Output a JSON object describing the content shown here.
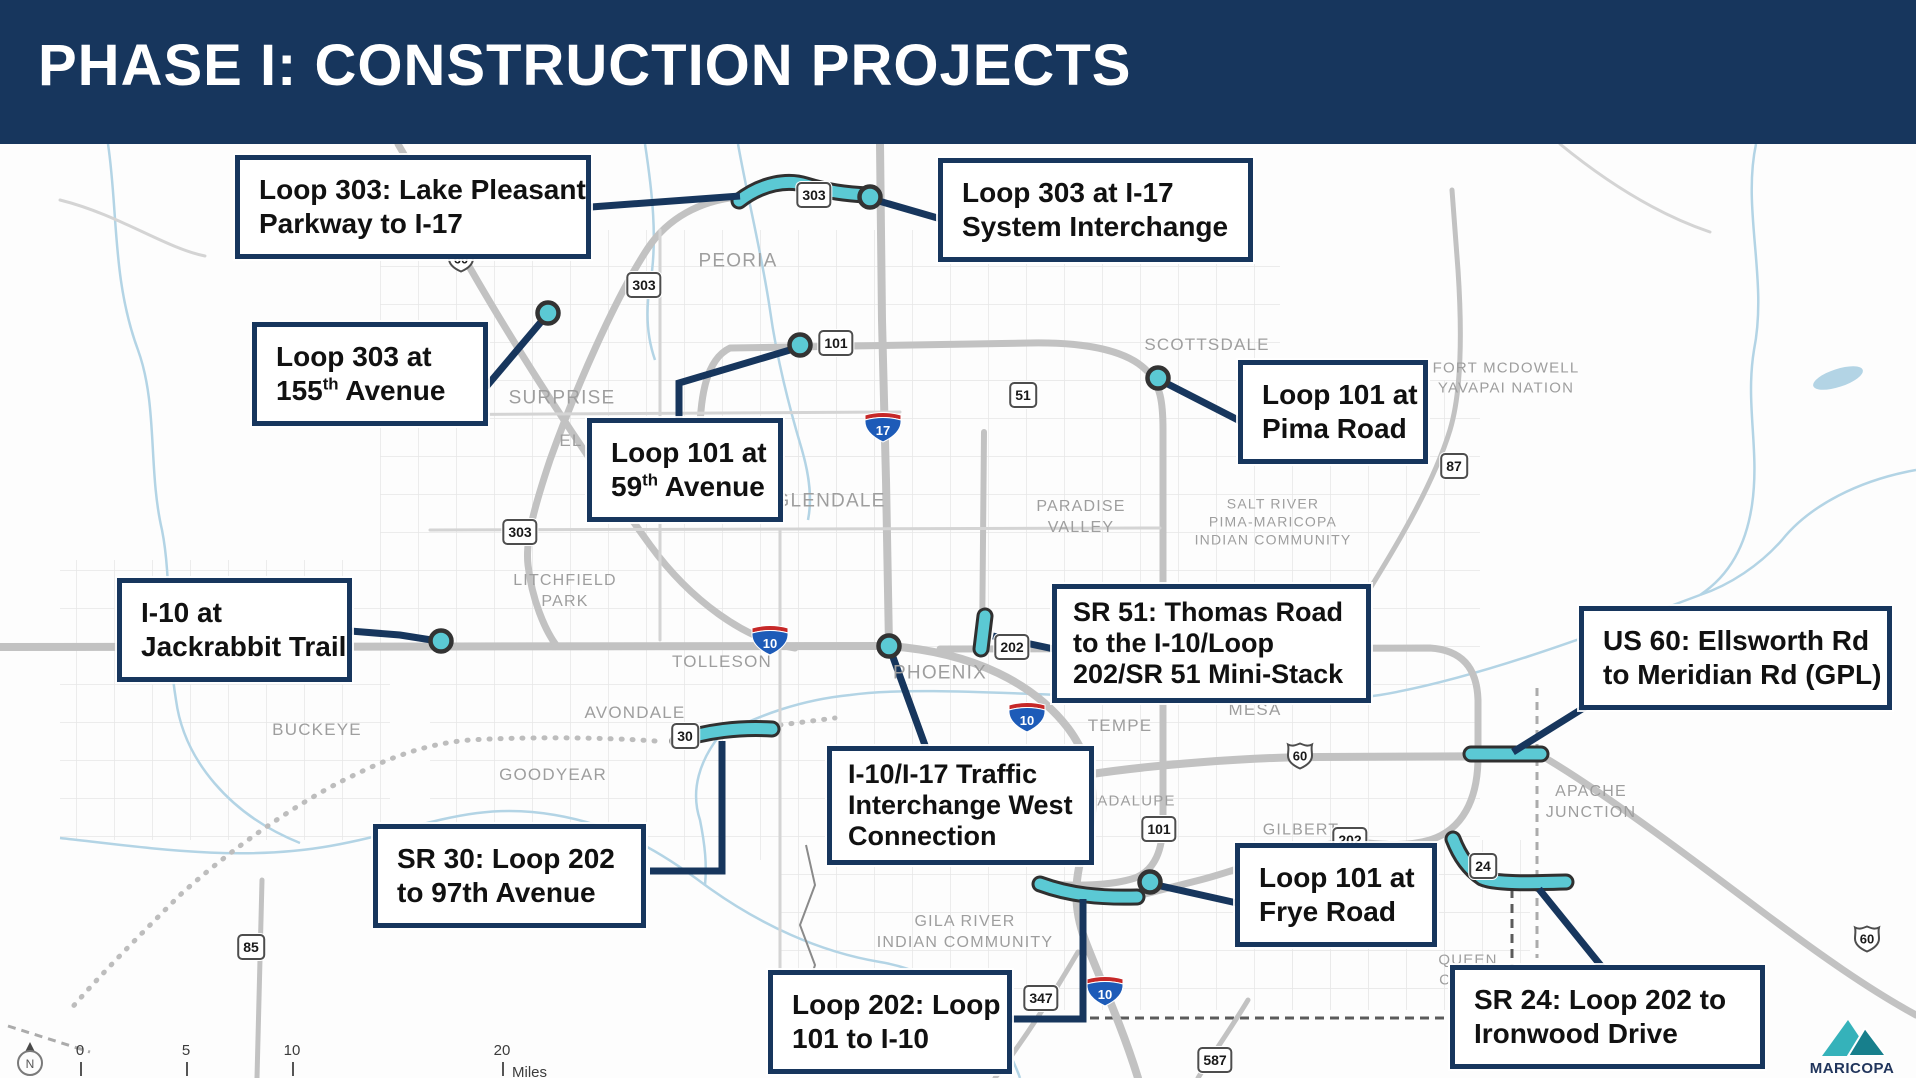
{
  "header": {
    "title": "PHASE I: CONSTRUCTION PROJECTS"
  },
  "colors": {
    "navy": "#17365d",
    "teal": "#5bc9d4",
    "road_gray": "#c6c6c6",
    "river_blue": "#b3d4e5",
    "label_gray": "#9e9e9e"
  },
  "map": {
    "callouts": [
      {
        "id": "loop303-lake-pleasant",
        "x": 235,
        "y": 155,
        "w": 356,
        "compact": false,
        "lines": [
          "Loop 303: Lake Pleasant",
          "Parkway to I-17"
        ]
      },
      {
        "id": "loop303-i17-interchange",
        "x": 938,
        "y": 158,
        "w": 315,
        "compact": false,
        "lines": [
          "Loop 303 at I-17",
          "System Interchange"
        ]
      },
      {
        "id": "loop303-155th-ave",
        "x": 252,
        "y": 322,
        "w": 236,
        "compact": false,
        "lines": [
          "Loop 303 at",
          "155^th^ Avenue"
        ]
      },
      {
        "id": "loop101-59th-ave",
        "x": 587,
        "y": 418,
        "w": 196,
        "compact": false,
        "lines": [
          "Loop 101 at",
          "59^th^ Avenue"
        ]
      },
      {
        "id": "loop101-pima-road",
        "x": 1238,
        "y": 360,
        "w": 190,
        "compact": false,
        "lines": [
          "Loop 101 at",
          "Pima Road"
        ]
      },
      {
        "id": "i10-jackrabbit-trail",
        "x": 117,
        "y": 578,
        "w": 235,
        "compact": false,
        "lines": [
          "I-10 at",
          "Jackrabbit Trail"
        ]
      },
      {
        "id": "sr51-thomas-road",
        "x": 1052,
        "y": 584,
        "w": 325,
        "compact": true,
        "lines": [
          "SR 51: Thomas Road",
          "to the I-10/Loop",
          "202/SR 51 Mini-Stack"
        ]
      },
      {
        "id": "us60-ellsworth-meridian",
        "x": 1579,
        "y": 606,
        "w": 313,
        "compact": false,
        "lines": [
          "US 60: Ellsworth Rd",
          "to Meridian Rd (GPL)"
        ]
      },
      {
        "id": "i10-i17-west-connection",
        "x": 827,
        "y": 746,
        "w": 273,
        "compact": true,
        "lines": [
          "I-10/I-17 Traffic",
          "Interchange West",
          "Connection"
        ]
      },
      {
        "id": "sr30-loop202-97th",
        "x": 373,
        "y": 824,
        "w": 273,
        "compact": false,
        "lines": [
          "SR 30: Loop 202",
          "to 97th Avenue"
        ]
      },
      {
        "id": "loop101-frye-road",
        "x": 1235,
        "y": 843,
        "w": 202,
        "compact": false,
        "lines": [
          "Loop 101 at",
          "Frye Road"
        ]
      },
      {
        "id": "loop202-101-to-i10",
        "x": 768,
        "y": 970,
        "w": 244,
        "compact": false,
        "lines": [
          "Loop 202: Loop",
          "101 to I-10"
        ]
      },
      {
        "id": "sr24-loop202-ironwood",
        "x": 1450,
        "y": 965,
        "w": 315,
        "compact": false,
        "lines": [
          "SR 24: Loop 202 to",
          "Ironwood Drive"
        ]
      }
    ],
    "labels": [
      {
        "text": "PEORIA",
        "x": 738,
        "y": 262,
        "fs": 19
      },
      {
        "text": "SURPRISE",
        "x": 562,
        "y": 399,
        "fs": 19
      },
      {
        "text": "EL",
        "x": 571,
        "y": 441,
        "fs": 17
      },
      {
        "text": "GLENDALE",
        "x": 830,
        "y": 502,
        "fs": 19
      },
      {
        "text": "LITCHFIELD\nPARK",
        "x": 565,
        "y": 592,
        "fs": 16
      },
      {
        "text": "TOLLESON",
        "x": 722,
        "y": 662,
        "fs": 17
      },
      {
        "text": "AVONDALE",
        "x": 635,
        "y": 713,
        "fs": 17
      },
      {
        "text": "GOODYEAR",
        "x": 553,
        "y": 775,
        "fs": 17
      },
      {
        "text": "BUCKEYE",
        "x": 317,
        "y": 730,
        "fs": 17
      },
      {
        "text": "PHOENIX",
        "x": 940,
        "y": 674,
        "fs": 19
      },
      {
        "text": "PARADISE\nVALLEY",
        "x": 1081,
        "y": 518,
        "fs": 16
      },
      {
        "text": "SCOTTSDALE",
        "x": 1207,
        "y": 345,
        "fs": 17
      },
      {
        "text": "FORT MCDOWELL\nYAVAPAI NATION",
        "x": 1506,
        "y": 378,
        "fs": 15
      },
      {
        "text": "SALT RIVER\nPIMA-MARICOPA\nINDIAN COMMUNITY",
        "x": 1273,
        "y": 522,
        "fs": 14
      },
      {
        "text": "TEMPE",
        "x": 1120,
        "y": 726,
        "fs": 17
      },
      {
        "text": "MESA",
        "x": 1255,
        "y": 710,
        "fs": 17
      },
      {
        "text": "GILBERT",
        "x": 1301,
        "y": 831,
        "fs": 16
      },
      {
        "text": "GUADALUPE",
        "x": 1124,
        "y": 801,
        "fs": 15
      },
      {
        "text": "APACHE\nJUNCTION",
        "x": 1591,
        "y": 803,
        "fs": 16
      },
      {
        "text": "GILA RIVER\nINDIAN COMMUNITY",
        "x": 965,
        "y": 933,
        "fs": 16
      },
      {
        "text": "QUEEN\nCREEK",
        "x": 1468,
        "y": 970,
        "fs": 15
      }
    ],
    "shields": [
      {
        "type": "state",
        "label": "303",
        "x": 814,
        "y": 196
      },
      {
        "type": "state",
        "label": "303",
        "x": 644,
        "y": 286
      },
      {
        "type": "state",
        "label": "303",
        "x": 520,
        "y": 533
      },
      {
        "type": "state",
        "label": "101",
        "x": 836,
        "y": 344
      },
      {
        "type": "state",
        "label": "101",
        "x": 1159,
        "y": 830
      },
      {
        "type": "state",
        "label": "51",
        "x": 1023,
        "y": 396
      },
      {
        "type": "state",
        "label": "87",
        "x": 1454,
        "y": 467
      },
      {
        "type": "state",
        "label": "202",
        "x": 1012,
        "y": 648
      },
      {
        "type": "state",
        "label": "202",
        "x": 1350,
        "y": 841
      },
      {
        "type": "state",
        "label": "24",
        "x": 1483,
        "y": 867
      },
      {
        "type": "state",
        "label": "30",
        "x": 685,
        "y": 737
      },
      {
        "type": "state",
        "label": "347",
        "x": 1041,
        "y": 999
      },
      {
        "type": "state",
        "label": "587",
        "x": 1215,
        "y": 1061
      },
      {
        "type": "state",
        "label": "85",
        "x": 251,
        "y": 948
      },
      {
        "type": "interstate",
        "label": "17",
        "x": 883,
        "y": 429
      },
      {
        "type": "interstate",
        "label": "10",
        "x": 770,
        "y": 642
      },
      {
        "type": "interstate",
        "label": "10",
        "x": 1027,
        "y": 719
      },
      {
        "type": "interstate",
        "label": "10",
        "x": 1105,
        "y": 993
      },
      {
        "type": "us",
        "label": "60",
        "x": 461,
        "y": 260
      },
      {
        "type": "us",
        "label": "60",
        "x": 1300,
        "y": 757
      },
      {
        "type": "us",
        "label": "60",
        "x": 1867,
        "y": 940
      }
    ],
    "scalebar": {
      "ticks": [
        {
          "label": "0",
          "x": 80
        },
        {
          "label": "5",
          "x": 186
        },
        {
          "label": "10",
          "x": 292
        },
        {
          "label": "20",
          "x": 502
        }
      ],
      "unit": "Miles"
    },
    "compass": {
      "letter": "N"
    },
    "logo": {
      "line1": "MARICOPA",
      "line2": "ASSOCIATION of"
    }
  }
}
